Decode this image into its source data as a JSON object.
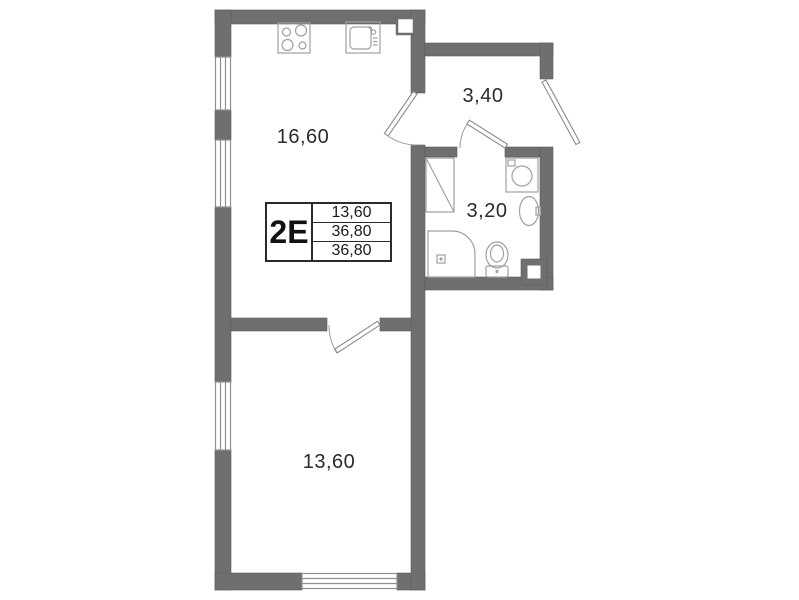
{
  "plan": {
    "title": "apartment-floor-plan",
    "unit_type": "2E",
    "info_table": {
      "unit_label": "2E",
      "rows": [
        "13,60",
        "36,80",
        "36,80"
      ]
    },
    "rooms": {
      "kitchen_living": {
        "area": "16,60"
      },
      "hallway": {
        "area": "3,40"
      },
      "bathroom": {
        "area": "3,20"
      },
      "bedroom": {
        "area": "13,60"
      }
    },
    "fixtures": [
      "stove-icon",
      "kitchen-sink-icon",
      "water-heater-icon",
      "washing-machine-icon",
      "bathroom-sink-icon",
      "corner-shower-icon",
      "toilet-icon",
      "vent-shaft-icon"
    ],
    "colors": {
      "wall": "#6f6f6f",
      "wall_edge": "#5d5d5d",
      "thin_line": "#9a9a9a",
      "door_line": "#8a8a8a",
      "text": "#2b2b2b",
      "background": "#ffffff"
    }
  }
}
